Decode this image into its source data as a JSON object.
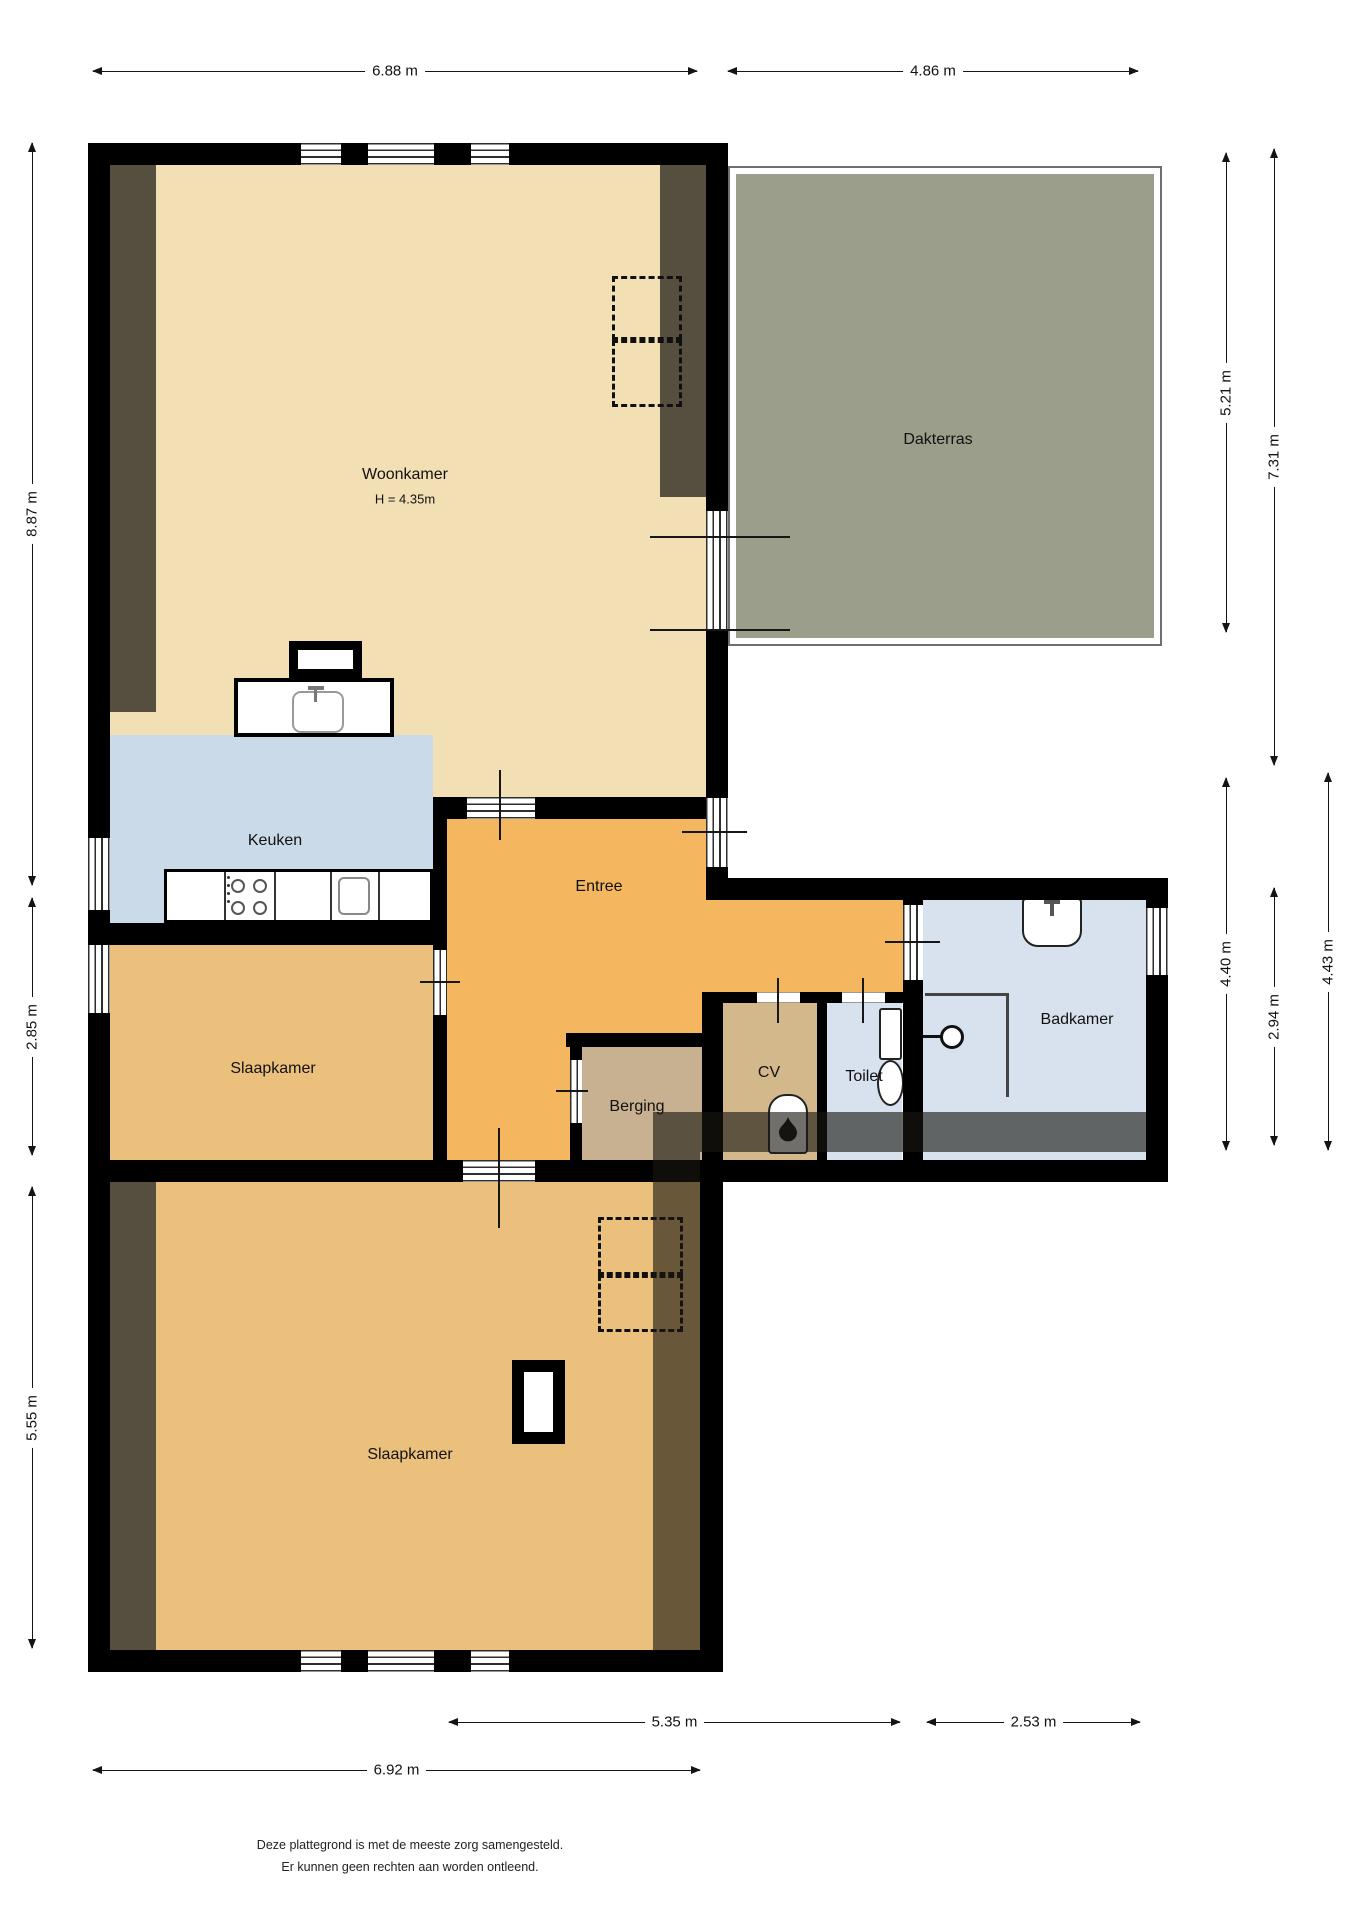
{
  "rooms": {
    "woonkamer": {
      "name": "Woonkamer",
      "height_note": "H = 4.35m"
    },
    "dakterras": {
      "name": "Dakterras"
    },
    "keuken": {
      "name": "Keuken"
    },
    "entree": {
      "name": "Entree"
    },
    "slaapkamer_boven": {
      "name": "Slaapkamer"
    },
    "slaapkamer_onder": {
      "name": "Slaapkamer"
    },
    "badkamer": {
      "name": "Badkamer"
    },
    "toilet": {
      "name": "Toilet"
    },
    "cv": {
      "name": "CV"
    },
    "berging": {
      "name": "Berging"
    }
  },
  "dimensions": {
    "top_left": "6.88 m",
    "top_right": "4.86 m",
    "left_upper": "8.87 m",
    "left_middle": "2.85 m",
    "left_lower": "5.55 m",
    "right_terrace": "5.21 m",
    "right_upper_total": "7.31 m",
    "right_wing": "4.40 m",
    "right_wing_inner": "2.94 m",
    "right_wing_outer": "4.43 m",
    "bottom_wing": "5.35 m",
    "bottom_right": "2.53 m",
    "bottom_left": "6.92 m"
  },
  "footer": {
    "line1": "Deze plattegrond is met de meeste zorg samengesteld.",
    "line2": "Er kunnen geen rechten aan worden ontleend."
  },
  "colors": {
    "wall": "#000000",
    "living_floor": "#F2DFB4",
    "sloped_area": "#564F40",
    "kitchen_floor": "#CBDAE8",
    "hall_floor": "#F4B65F",
    "bedroom_floor": "#EBC07D",
    "storage_floor": "#C8B191",
    "cv_floor": "#D3B88C",
    "bath_floor": "#D7E2EE",
    "terrace_floor": "#9A9E8B",
    "overlay": "rgba(25,22,16,0.62)"
  }
}
